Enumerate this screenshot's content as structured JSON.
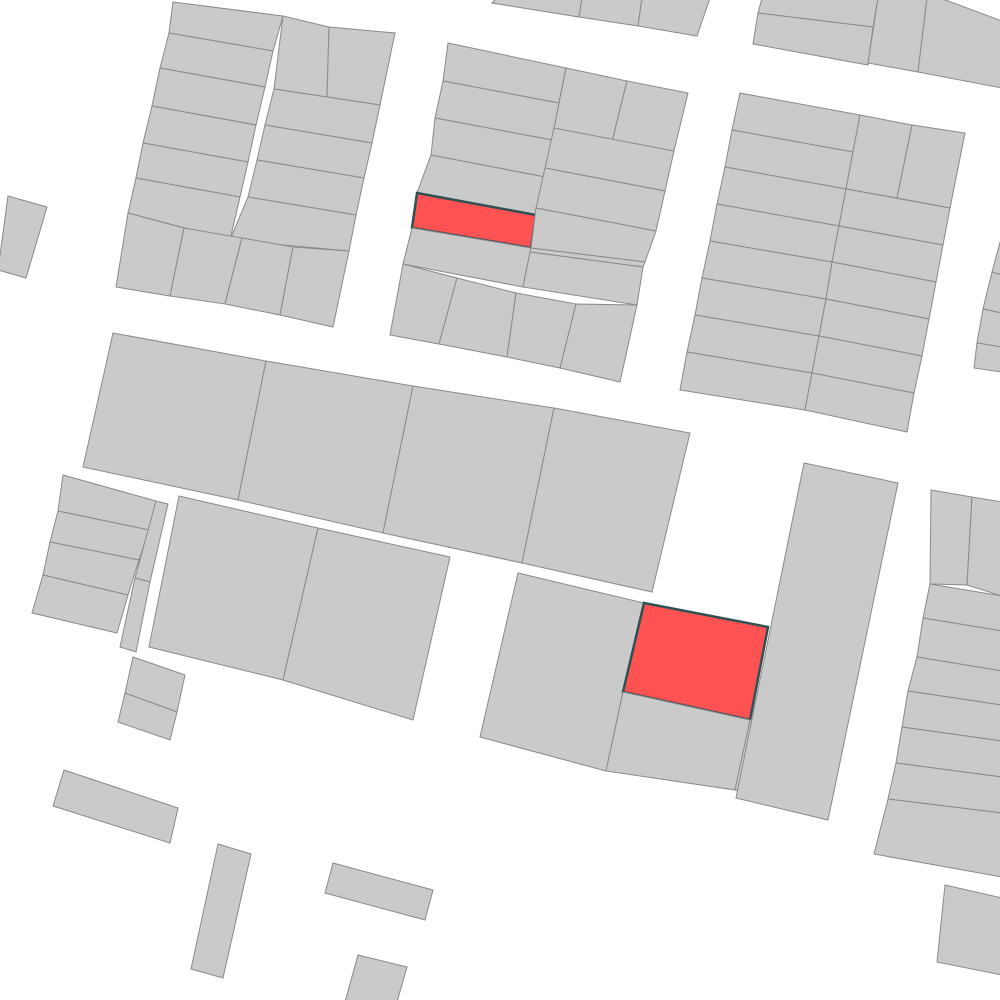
{
  "canvas": {
    "width": 1000,
    "height": 1000,
    "background_color": "#ffffff"
  },
  "styles": {
    "parcel_fill": "#cacaca",
    "parcel_stroke": "#8a8a8a",
    "parcel_stroke_width": 1,
    "highlight_fill": "#ff5252",
    "highlight_stroke": "#2e5154",
    "highlight_stroke_width": 2.5
  },
  "map": {
    "groups": [
      {
        "name": "block-top-left",
        "parcels": [
          {
            "pts": "173,2 283,16 273,51 169,33"
          },
          {
            "pts": "169,33 273,51 265,87 160,68"
          },
          {
            "pts": "160,68 265,87 256,125 152,106"
          },
          {
            "pts": "152,106 256,125 248,162 143,143"
          },
          {
            "pts": "143,143 248,162 240,197 136,178"
          },
          {
            "pts": "136,178 240,197 230,240 128,213"
          },
          {
            "pts": "283,16 329,27 327,97 274,89"
          },
          {
            "pts": "329,27 395,33 380,105 327,97"
          },
          {
            "pts": "274,89 327,97 380,105 372,143 265,125"
          },
          {
            "pts": "265,125 372,143 364,178 257,160"
          },
          {
            "pts": "257,160 364,178 356,215 248,197"
          },
          {
            "pts": "248,197 356,215 349,251 230,240"
          },
          {
            "pts": "128,213 184,228 170,296 116,287"
          },
          {
            "pts": "184,228 242,238 225,304 170,296"
          },
          {
            "pts": "242,238 293,247 280,315 225,304"
          },
          {
            "pts": "293,247 349,251 333,327 280,315"
          }
        ]
      },
      {
        "name": "left-edge-sliver",
        "parcels": [
          {
            "pts": "8,196 47,207 26,278 -2,270"
          }
        ]
      },
      {
        "name": "block-top-strip",
        "parcels": [
          {
            "pts": "497,-2 582,-2 579,17 492,3"
          },
          {
            "pts": "582,-2 642,-2 638,26 579,17"
          },
          {
            "pts": "642,-2 710,-2 697,36 638,26"
          }
        ]
      },
      {
        "name": "block-top-corner",
        "parcels": [
          {
            "pts": "762,-2 878,-2 873,27 758,13"
          },
          {
            "pts": "758,13 873,27 868,65 753,44"
          },
          {
            "pts": "878,-2 927,-2 918,72 868,63"
          },
          {
            "pts": "927,-2 940,-2 1002,21 1002,88 918,72"
          }
        ]
      },
      {
        "name": "block-top-middle",
        "parcels": [
          {
            "pts": "448,43 566,68 559,103 443,81"
          },
          {
            "pts": "443,81 559,103 552,140 435,118"
          },
          {
            "pts": "435,118 552,140 545,177 431,155"
          },
          {
            "pts": "431,155 545,177 536,215 417,193"
          },
          {
            "pts": "417,193 536,215 531,248 412,228",
            "h": true
          },
          {
            "pts": "412,228 531,248 523,287 403,264"
          },
          {
            "pts": "566,68 627,81 612,142 554,128"
          },
          {
            "pts": "627,81 688,93 674,151 612,142"
          },
          {
            "pts": "554,128 674,151 665,191 545,168"
          },
          {
            "pts": "545,168 665,191 656,231 536,208"
          },
          {
            "pts": "536,208 656,231 645,262 531,248"
          },
          {
            "pts": "531,248 645,262 643,267 530,252"
          },
          {
            "pts": "530,252 643,267 637,305 523,287"
          },
          {
            "pts": "403,264 457,278 439,344 390,335"
          },
          {
            "pts": "457,278 516,293 507,357 439,344"
          },
          {
            "pts": "516,293 576,304 560,368 507,357"
          },
          {
            "pts": "576,304 637,305 620,382 560,368"
          }
        ]
      },
      {
        "name": "block-top-right",
        "parcels": [
          {
            "pts": "740,93 860,115 853,152 732,130"
          },
          {
            "pts": "732,130 853,152 846,189 725,167"
          },
          {
            "pts": "725,167 846,189 839,226 717,204"
          },
          {
            "pts": "717,204 839,226 832,262 710,241"
          },
          {
            "pts": "710,241 832,262 826,299 702,278"
          },
          {
            "pts": "702,278 826,299 819,336 695,315"
          },
          {
            "pts": "695,315 819,336 812,373 687,352"
          },
          {
            "pts": "687,352 812,373 805,410 680,390"
          },
          {
            "pts": "860,115 912,125 897,198 846,189"
          },
          {
            "pts": "912,125 965,133 950,208 897,198"
          },
          {
            "pts": "846,189 950,208 943,245 839,226"
          },
          {
            "pts": "839,226 943,245 936,282 832,262"
          },
          {
            "pts": "832,262 936,282 929,319 826,299"
          },
          {
            "pts": "826,299 929,319 922,356 819,336"
          },
          {
            "pts": "819,336 922,356 914,393 812,373"
          },
          {
            "pts": "812,373 914,393 907,432 805,410"
          }
        ]
      },
      {
        "name": "right-edge-slivers",
        "parcels": [
          {
            "pts": "1002,235 1002,275 992,272"
          },
          {
            "pts": "992,272 1002,275 1002,313 983,309"
          },
          {
            "pts": "983,309 1002,313 1002,347 977,343"
          },
          {
            "pts": "977,343 1002,347 1002,372 974,368"
          }
        ]
      },
      {
        "name": "middle-band",
        "parcels": [
          {
            "pts": "113,333 266,361 238,500 83,467"
          },
          {
            "pts": "266,361 413,386 383,533 238,500"
          },
          {
            "pts": "413,386 554,408 522,563 383,533"
          },
          {
            "pts": "554,408 690,433 652,592 522,563"
          }
        ]
      },
      {
        "name": "left-rows-block",
        "parcels": [
          {
            "pts": "63,475 156,501 149,530 58,511"
          },
          {
            "pts": "58,511 149,530 139,560 50,542"
          },
          {
            "pts": "50,542 139,560 128,595 43,575"
          },
          {
            "pts": "43,575 128,595 117,633 32,613"
          }
        ]
      },
      {
        "name": "left-strips",
        "parcels": [
          {
            "pts": "156,501 168,504 150,582 135,578"
          },
          {
            "pts": "135,578 150,582 136,652 120,647"
          }
        ]
      },
      {
        "name": "left-small-block",
        "parcels": [
          {
            "pts": "133,657 185,675 177,712 125,693"
          },
          {
            "pts": "125,693 177,712 170,740 118,722"
          }
        ]
      },
      {
        "name": "second-band",
        "parcels": [
          {
            "pts": "179,496 318,528 283,680 149,647"
          },
          {
            "pts": "318,528 450,557 413,720 283,680"
          }
        ]
      },
      {
        "name": "block-bottom-middle",
        "parcels": [
          {
            "pts": "518,573 644,603 623,692 606,771 480,737"
          },
          {
            "pts": "644,603 768,627 750,720 623,692",
            "h": true
          },
          {
            "pts": "623,692 750,720 735,790 606,771"
          },
          {
            "pts": "750,720 757,721 742,792 735,790"
          }
        ]
      },
      {
        "name": "tall-block-right",
        "parcels": [
          {
            "pts": "804,463 898,483 828,820 736,798"
          }
        ]
      },
      {
        "name": "right-column",
        "parcels": [
          {
            "pts": "931,490 972,497 967,585 930,584"
          },
          {
            "pts": "972,497 1002,502 1002,596 967,585"
          },
          {
            "pts": "930,584 1002,596 1002,631 923,618"
          },
          {
            "pts": "923,618 1002,631 1002,671 917,657"
          },
          {
            "pts": "917,657 1002,671 1002,705 908,691"
          },
          {
            "pts": "908,691 1002,705 1002,741 902,727"
          },
          {
            "pts": "902,727 1002,741 1002,777 896,763"
          },
          {
            "pts": "896,763 1002,777 1002,813 888,799"
          },
          {
            "pts": "888,799 1002,813 1002,877 874,854"
          }
        ]
      },
      {
        "name": "bottom-right-parcel",
        "parcels": [
          {
            "pts": "945,885 1002,898 1002,975 937,962"
          }
        ]
      },
      {
        "name": "scattered-south",
        "parcels": [
          {
            "pts": "64,770 178,808 170,843 53,806"
          },
          {
            "pts": "218,844 251,854 223,978 191,969"
          },
          {
            "pts": "333,863 433,890 425,920 325,893"
          },
          {
            "pts": "358,955 407,967 397,1002 345,1002"
          }
        ]
      }
    ]
  }
}
